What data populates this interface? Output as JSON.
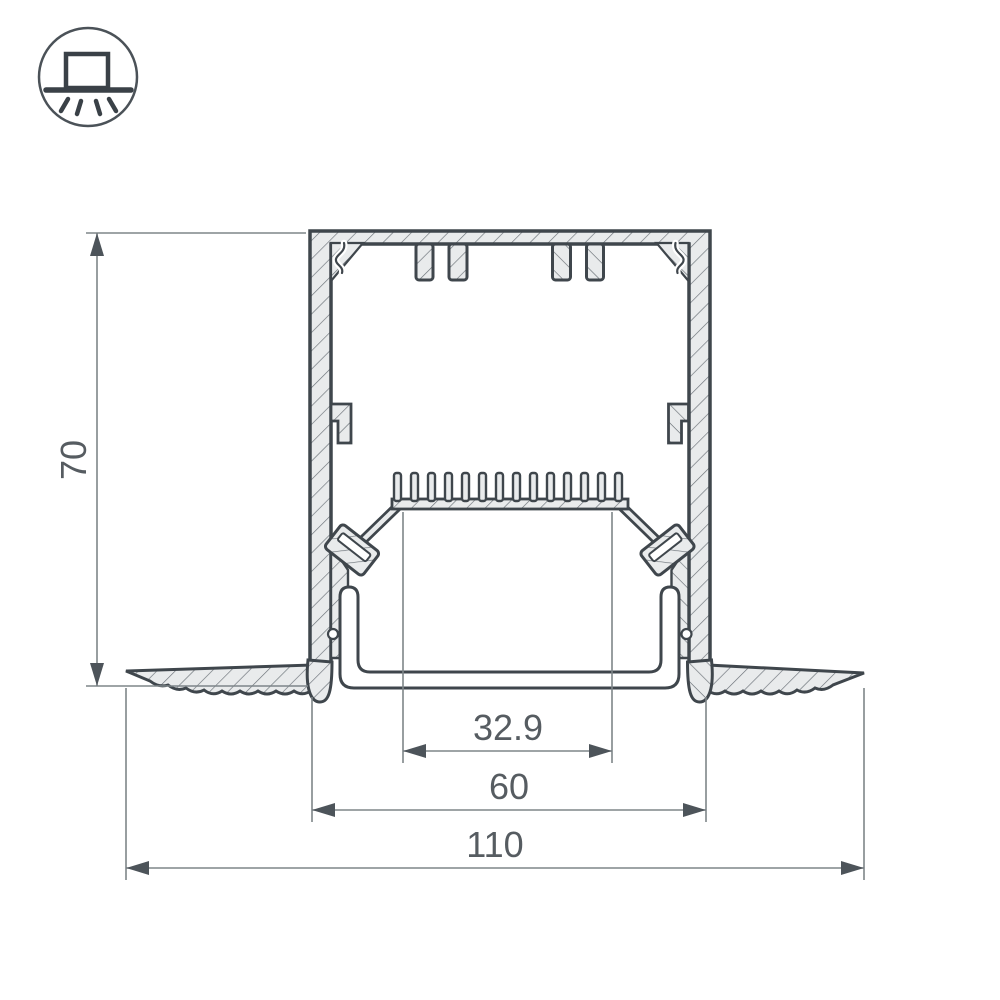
{
  "drawing": {
    "kind": "recessed-led-profile-cross-section",
    "dimensions": {
      "height": "70",
      "opening_width": "32.9",
      "body_width": "60",
      "overall_width": "110"
    }
  },
  "icon": {
    "name": "recessed-mount-light-icon"
  },
  "colors": {
    "outline": "#3f464c",
    "fill": "#e9ebec",
    "hatch": "#6a7177",
    "dim_line": "#7e8589",
    "dim_text": "#565c61"
  }
}
